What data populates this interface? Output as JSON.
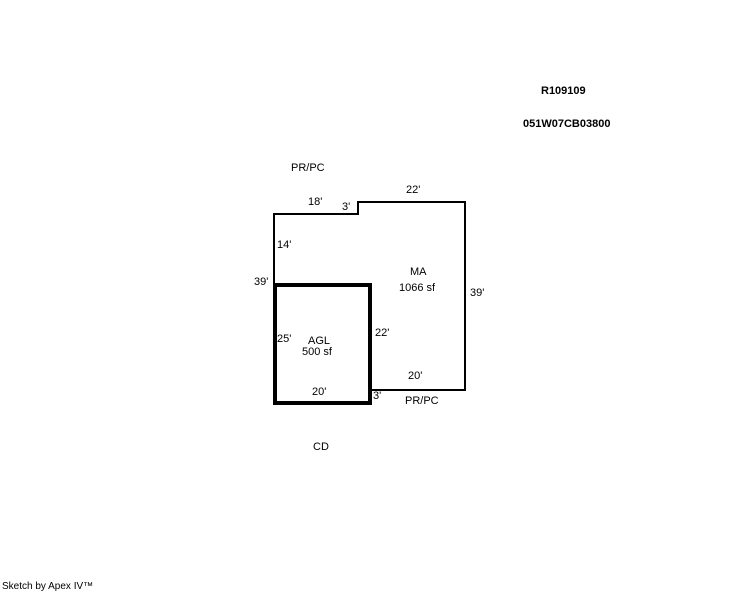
{
  "colors": {
    "background": "#ffffff",
    "line": "#000000",
    "text": "#000000"
  },
  "header": {
    "record_id": "R109109",
    "parcel_id": "051W07CB03800"
  },
  "sketch": {
    "areas": [
      {
        "code": "MA",
        "size": "1066 sf"
      },
      {
        "code": "AGL",
        "size": "500 sf"
      }
    ],
    "annotations": {
      "prpc_top": "PR/PC",
      "prpc_bottom": "PR/PC",
      "cd": "CD"
    },
    "dimensions": {
      "ma_top_left": "18'",
      "ma_top_step": "3'",
      "ma_top_right": "22'",
      "ma_left_upper": "14'",
      "left_total": "39'",
      "ma_right": "39'",
      "agl_left": "25'",
      "agl_right_inner": "22'",
      "agl_bottom": "20'",
      "ma_bottom": "20'",
      "ma_bottom_step": "3'"
    }
  },
  "footer": {
    "credit": "Sketch by Apex IV™"
  }
}
